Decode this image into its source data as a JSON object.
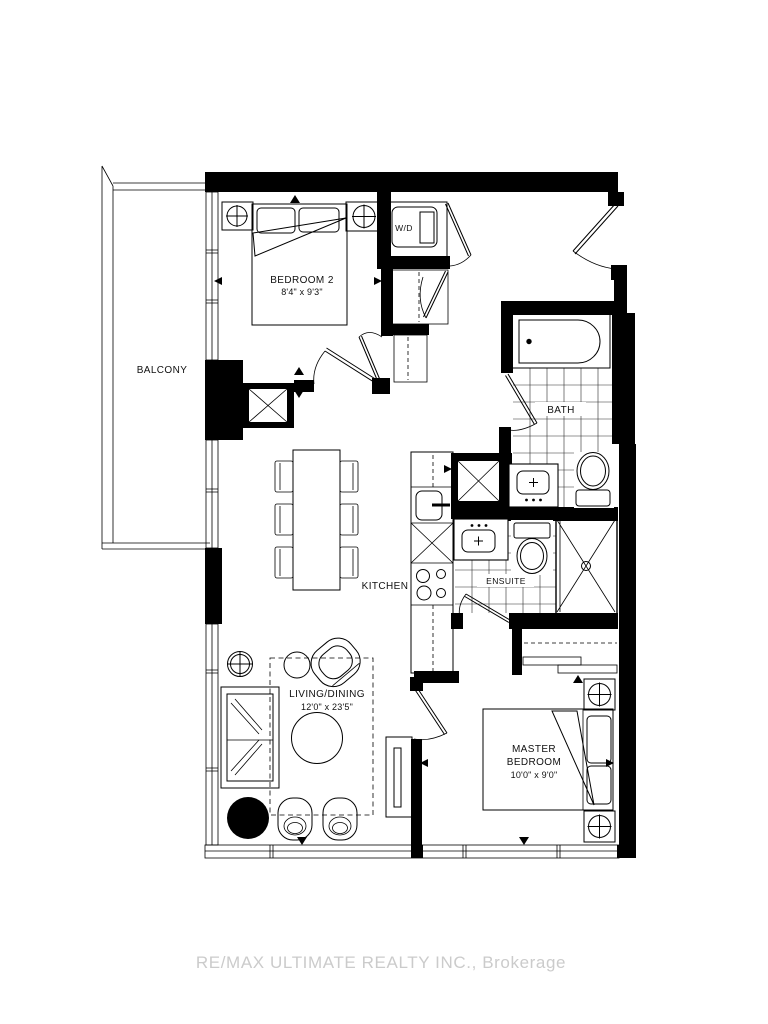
{
  "floor_plan": {
    "rooms": {
      "balcony": {
        "label": "BALCONY"
      },
      "bedroom_2": {
        "label": "BEDROOM 2",
        "dimensions": "8'4\" x 9'3\""
      },
      "laundry": {
        "label": "W/D"
      },
      "bath": {
        "label": "BATH"
      },
      "kitchen": {
        "label": "KITCHEN"
      },
      "ensuite": {
        "label": "ENSUITE"
      },
      "living_dining": {
        "label": "LIVING/DINING",
        "dimensions": "12'0\" x 23'5\""
      },
      "master_bedroom": {
        "label_line_1": "MASTER",
        "label_line_2": "BEDROOM",
        "dimensions": "10'0\" x 9'0\""
      }
    },
    "colors": {
      "walls": "#000000",
      "lines": "#1a1a1a",
      "tile_lines": "#2b2b2b",
      "background": "#ffffff",
      "watermark": "#cbcbcb"
    }
  },
  "watermark": {
    "text": "RE/MAX ULTIMATE REALTY INC., Brokerage"
  }
}
